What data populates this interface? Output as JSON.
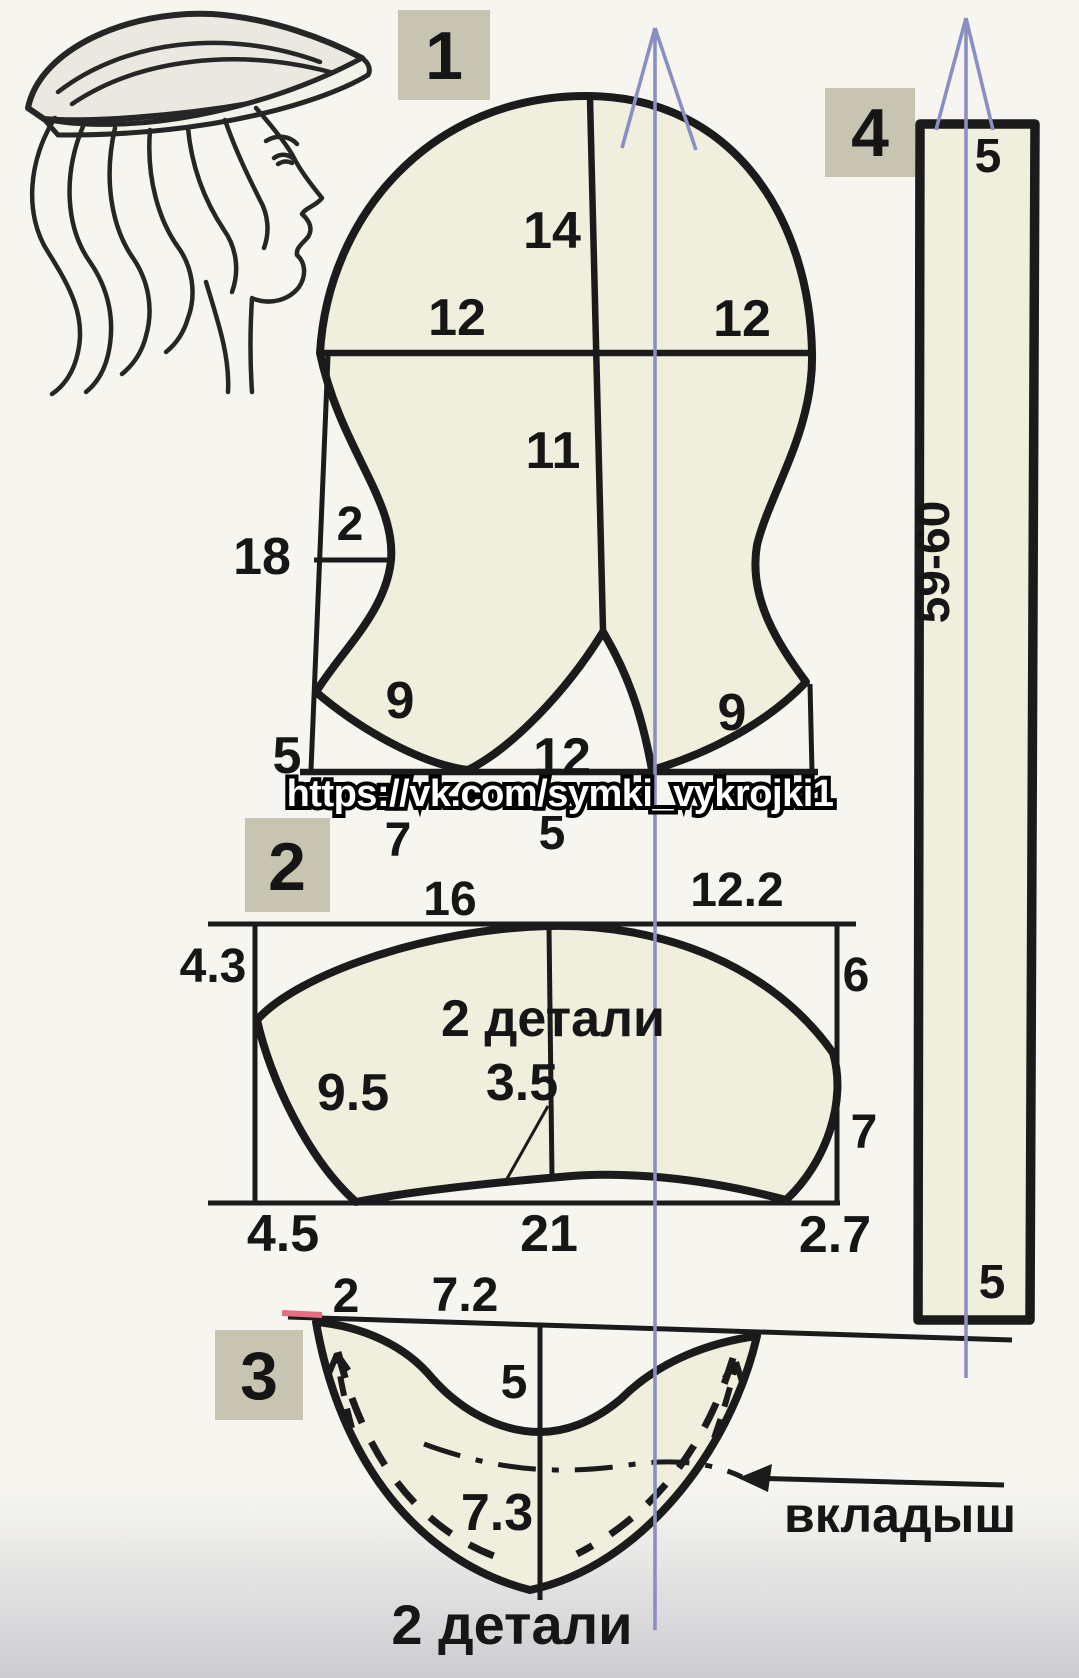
{
  "colors": {
    "paper": "#f6f5f0",
    "paper_bottom": "#cfcfd4",
    "piece_fill": "#f0eedc",
    "outline": "#1b1b1b",
    "label_box": "#c7c4b1",
    "grain_line": "#8a8fc2",
    "watermark": "#ffffff",
    "accent_mark": "#e46e7e"
  },
  "watermark": {
    "text": "https://vk.com/symki_vykrojki1"
  },
  "piece1": {
    "label": "1",
    "m_top": "14",
    "m_mid_left": "12",
    "m_mid_right": "12",
    "m_center": "11",
    "m_gap": "2",
    "m_side_left": "18",
    "m_low_left": "9",
    "m_low_right": "9",
    "m_side_bottom": "5",
    "m_notch": "12",
    "m_below_left": "7",
    "m_below_center": "5"
  },
  "piece2": {
    "label": "2",
    "note": "2 детали",
    "m_top_left": "16",
    "m_top_right": "12.2",
    "m_left": "4.3",
    "m_right_top": "6",
    "m_edge_left": "9.5",
    "m_arc": "3.5",
    "m_right_bottom": "7",
    "m_bottom_left": "4.5",
    "m_bottom_center": "21",
    "m_bottom_right": "2.7"
  },
  "piece3": {
    "label": "3",
    "m_left": "2",
    "m_top": "7.2",
    "m_depth": "5",
    "m_inner": "7.3",
    "note": "2 детали",
    "callout": "вкладыш"
  },
  "piece4": {
    "label": "4",
    "m_top": "5",
    "m_length": "59-60",
    "m_bottom": "5"
  }
}
